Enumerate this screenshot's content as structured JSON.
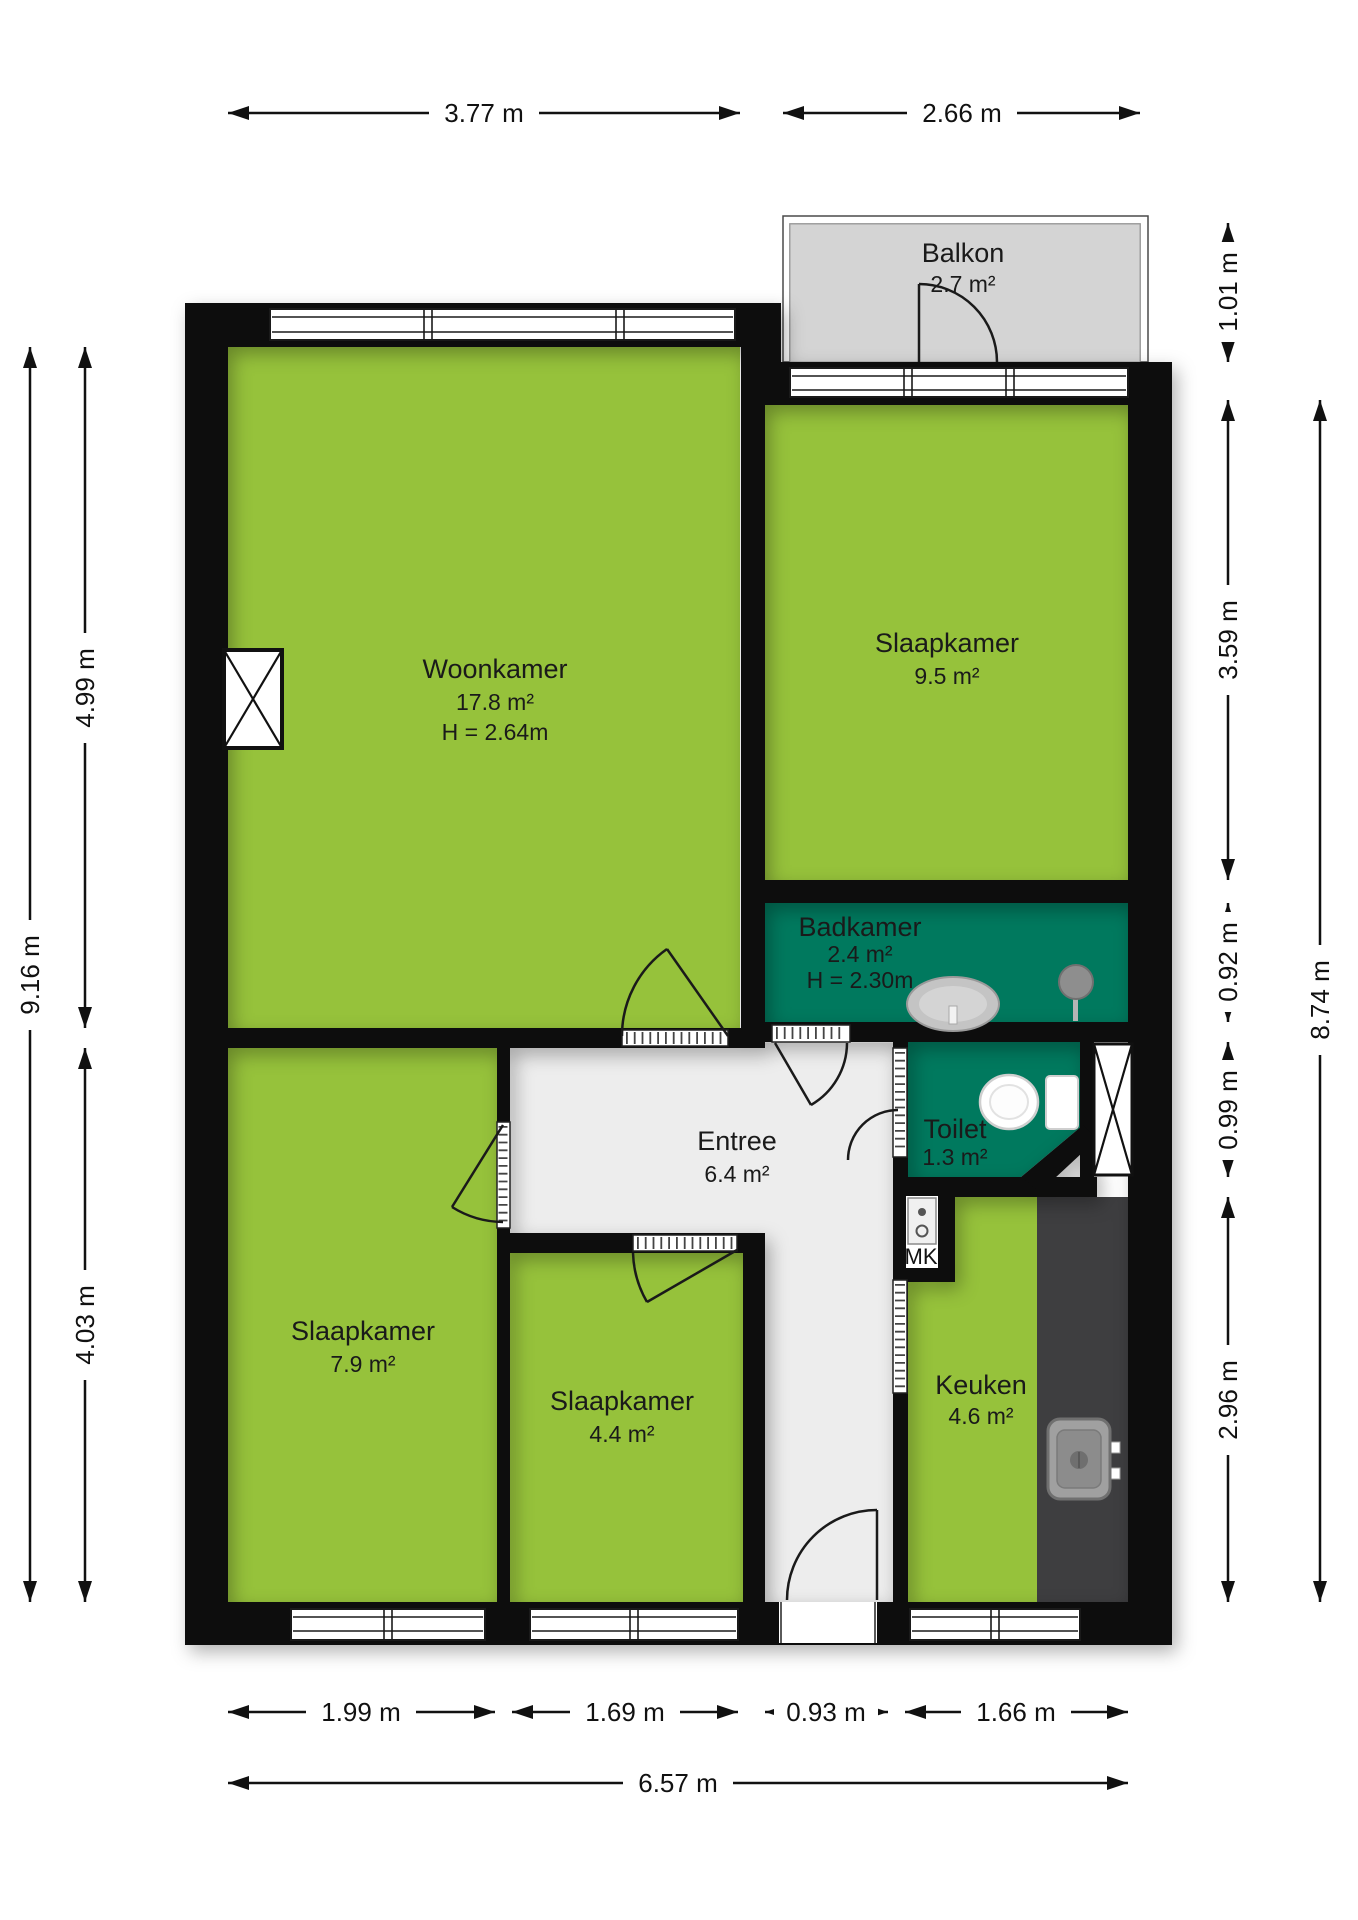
{
  "rooms": {
    "balkon": {
      "name": "Balkon",
      "area": "2.7 m²"
    },
    "woonkamer": {
      "name": "Woonkamer",
      "area": "17.8 m²",
      "ceiling_height": "H = 2.64m"
    },
    "slaapkamer_1": {
      "name": "Slaapkamer",
      "area": "9.5 m²"
    },
    "badkamer": {
      "name": "Badkamer",
      "area": "2.4 m²",
      "ceiling_height": "H = 2.30m"
    },
    "toilet": {
      "name": "Toilet",
      "area": "1.3 m²"
    },
    "entree": {
      "name": "Entree",
      "area": "6.4 m²"
    },
    "slaapkamer_2": {
      "name": "Slaapkamer",
      "area": "7.9 m²"
    },
    "slaapkamer_3": {
      "name": "Slaapkamer",
      "area": "4.4 m²"
    },
    "keuken": {
      "name": "Keuken",
      "area": "4.6 m²"
    },
    "meterkast": {
      "label": "MK"
    }
  },
  "dimensions": {
    "top": [
      {
        "label": "3.77 m"
      },
      {
        "label": "2.66 m"
      }
    ],
    "left": {
      "segments": [
        {
          "label": "4.99 m"
        },
        {
          "label": "4.03 m"
        }
      ],
      "total": {
        "label": "9.16 m"
      }
    },
    "right": {
      "segments": [
        {
          "label": "1.01 m"
        },
        {
          "label": "3.59 m"
        },
        {
          "label": "0.92 m"
        },
        {
          "label": "0.99 m"
        },
        {
          "label": "2.96 m"
        }
      ],
      "total": {
        "label": "8.74 m"
      }
    },
    "bottom": {
      "segments": [
        {
          "label": "1.99 m"
        },
        {
          "label": "1.69 m"
        },
        {
          "label": "0.93 m"
        },
        {
          "label": "1.66 m"
        }
      ],
      "total": {
        "label": "6.57 m"
      }
    }
  },
  "colors": {
    "room_green": "#96C23B",
    "wet_room_teal": "#00795E",
    "balcony_gray": "#D4D4D4",
    "entree_gray": "#EDEDED",
    "counter_dark": "#3E3E40",
    "wall_black": "#0D0D0D"
  },
  "icons": [
    {
      "name": "bath-sink-icon"
    },
    {
      "name": "shower-icon"
    },
    {
      "name": "toilet-icon"
    },
    {
      "name": "kitchen-sink-icon"
    },
    {
      "name": "electric-meter-icon"
    },
    {
      "name": "shaft-cross-icon"
    }
  ]
}
